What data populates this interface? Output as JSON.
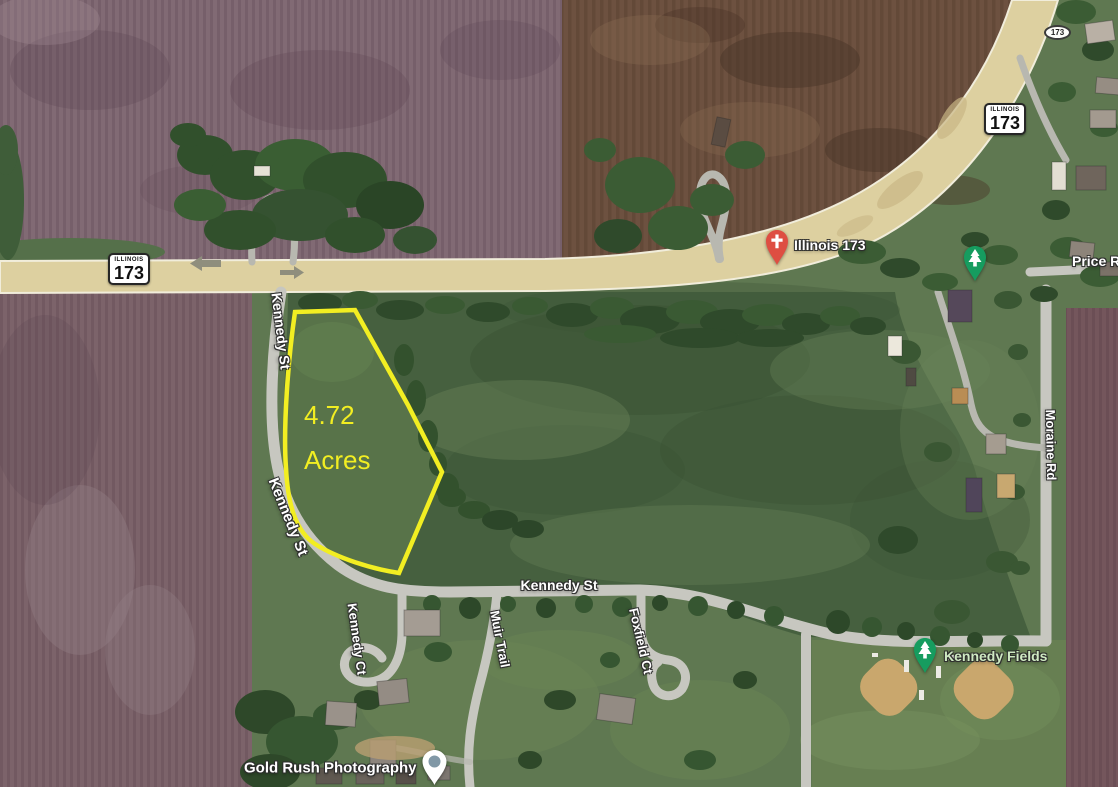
{
  "parcel": {
    "area": "4.72",
    "unit": "Acres",
    "outline_color": "#f2ee22"
  },
  "route_shields": {
    "west": {
      "state": "ILLINOIS",
      "route": "173"
    },
    "northeast": {
      "state": "ILLINOIS",
      "route": "173"
    },
    "badge_route": "173"
  },
  "street_labels": {
    "kennedy_st_upper": "Kennedy St",
    "kennedy_st_lower": "Kennedy St",
    "kennedy_st_east": "Kennedy St",
    "kennedy_ct": "Kennedy Ct",
    "muir_trail": "Muir Trail",
    "foxfield_ct": "Foxfield Ct",
    "moraine_rd": "Moraine Rd",
    "price_rd": "Price Rd"
  },
  "poi": {
    "illinois_173": {
      "label": "Illinois 173",
      "marker": "church-pin",
      "marker_color": "#de4e42"
    },
    "kennedy_fields": {
      "label": "Kennedy Fields",
      "marker": "park-pin",
      "marker_color": "#169c5f",
      "label_color": "#cfe9c2"
    },
    "route_173_park": {
      "marker": "park-pin",
      "marker_color": "#169c5f"
    },
    "gold_rush_photography": {
      "label": "Gold Rush Photography",
      "marker": "poi-pin",
      "marker_color": "#ffffff",
      "dot_color": "#8198a6"
    }
  },
  "colors": {
    "highway_tan": "#ddd0a0",
    "street_gray": "#c7c7c0",
    "meadow_green": "#46603f",
    "plowed_field_purple": "#7c636a",
    "plowed_field_brown": "#6d5140",
    "label_halo": "#2e2e2e"
  }
}
